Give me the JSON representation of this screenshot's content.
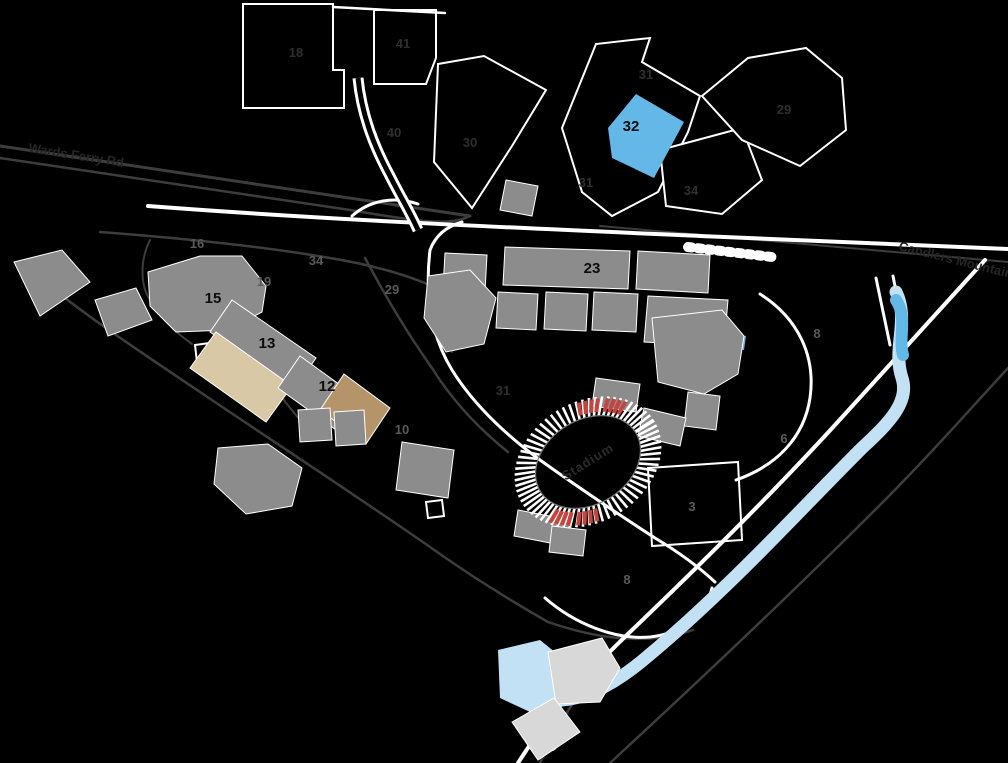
{
  "canvas": {
    "width": 1008,
    "height": 763,
    "background": "#000000"
  },
  "colors": {
    "building_gray": "#8c8c8c",
    "building_light": "#d8d8d8",
    "building_tan": "#d9c8a6",
    "building_brown": "#b5946a",
    "water_bright": "#64b8e8",
    "water_pale": "#c3e1f4",
    "road_white": "#ffffff",
    "road_gray": "#3d3d3d",
    "lot_outline": "#ffffff",
    "label_faint": "#2f2f2f",
    "label_mid": "#5a5a5a",
    "label_black": "#0d0d0d",
    "stadium_red": "#c4453d"
  },
  "streets": [
    {
      "name": "street-label-west",
      "text": "Wards Ferry Rd",
      "x": 28,
      "y": 152,
      "angle": 9
    },
    {
      "name": "street-label-east",
      "text": "Candlers Mountain Rd",
      "x": 898,
      "y": 250,
      "angle": 14
    }
  ],
  "stadium": {
    "label": "Stadium",
    "cx": 588,
    "cy": 462,
    "rotation": -32
  },
  "building_labels": [
    {
      "id": "15",
      "x": 213,
      "y": 303
    },
    {
      "id": "13",
      "x": 267,
      "y": 348
    },
    {
      "id": "12",
      "x": 327,
      "y": 391
    },
    {
      "id": "23",
      "x": 592,
      "y": 273
    },
    {
      "id": "32",
      "x": 631,
      "y": 131
    }
  ],
  "lot_labels": [
    {
      "id": "18",
      "x": 296,
      "y": 57,
      "tone": "faint"
    },
    {
      "id": "41",
      "x": 403,
      "y": 48,
      "tone": "faint"
    },
    {
      "id": "40",
      "x": 394,
      "y": 137,
      "tone": "faint"
    },
    {
      "id": "30",
      "x": 470,
      "y": 147,
      "tone": "faint"
    },
    {
      "id": "31",
      "x": 646,
      "y": 79,
      "tone": "faint"
    },
    {
      "id": "29",
      "x": 784,
      "y": 114,
      "tone": "faint"
    },
    {
      "id": "31",
      "x": 586,
      "y": 187,
      "tone": "faint"
    },
    {
      "id": "34",
      "x": 691,
      "y": 195,
      "tone": "faint"
    },
    {
      "id": "16",
      "x": 197,
      "y": 248,
      "tone": "mid"
    },
    {
      "id": "34",
      "x": 316,
      "y": 265,
      "tone": "mid"
    },
    {
      "id": "19",
      "x": 264,
      "y": 286,
      "tone": "mid"
    },
    {
      "id": "29",
      "x": 392,
      "y": 294,
      "tone": "mid"
    },
    {
      "id": "31",
      "x": 503,
      "y": 395,
      "tone": "faint"
    },
    {
      "id": "10",
      "x": 402,
      "y": 434,
      "tone": "mid"
    },
    {
      "id": "8",
      "x": 817,
      "y": 338,
      "tone": "mid"
    },
    {
      "id": "6",
      "x": 784,
      "y": 443,
      "tone": "mid"
    },
    {
      "id": "3",
      "x": 692,
      "y": 511,
      "tone": "mid"
    },
    {
      "id": "8",
      "x": 627,
      "y": 584,
      "tone": "mid"
    }
  ]
}
